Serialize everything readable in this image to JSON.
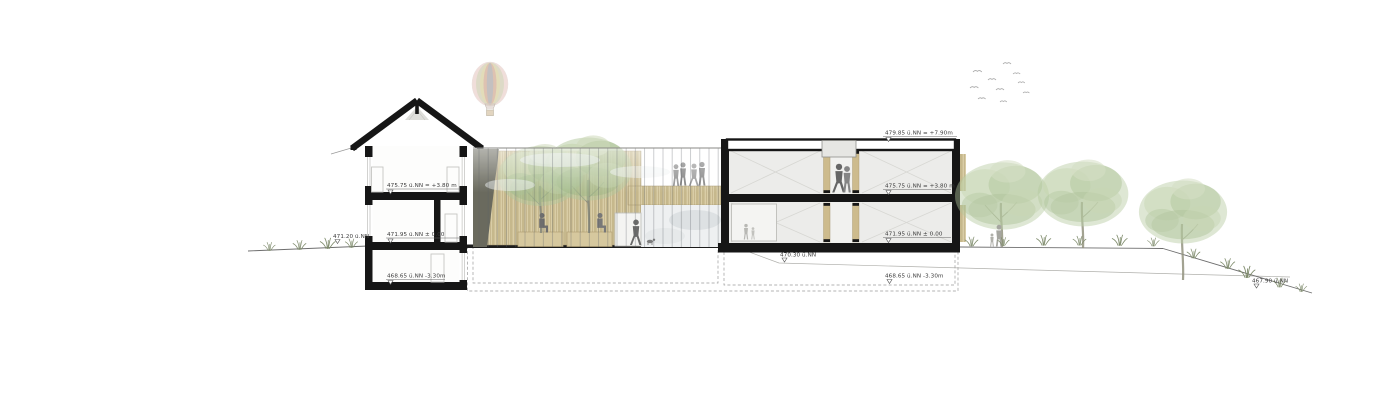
{
  "drawing": {
    "kind": "architectural-section-elevation",
    "colors": {
      "structure": "#161616",
      "timber": "#c9b88c",
      "foliage": "#aec69b",
      "terrain_line": "#6e6e6e",
      "annotation_text": "#3a3a3a"
    }
  },
  "annotations": [
    {
      "id": "left-building-upper-floor",
      "text": "475.75 ü.NN = +3.80 m"
    },
    {
      "id": "left-building-ground-floor",
      "text": "471.95 ü.NN ± 0.00"
    },
    {
      "id": "left-building-basement",
      "text": "468.65 ü.NN -3.30m"
    },
    {
      "id": "terrain-left",
      "text": "471.20 ü.NN"
    },
    {
      "id": "right-building-roof",
      "text": "479.85 ü.NN = +7.90m"
    },
    {
      "id": "right-building-upper-floor",
      "text": "475.75 ü.NN = +3.80 m"
    },
    {
      "id": "right-building-ground-floor",
      "text": "471.95 ü.NN ± 0.00"
    },
    {
      "id": "terrain-courtyard",
      "text": "470.30 ü.NN"
    },
    {
      "id": "right-building-basement",
      "text": "468.65 ü.NN -3.30m"
    },
    {
      "id": "terrain-far-right",
      "text": "467.90 ü.NN"
    }
  ]
}
